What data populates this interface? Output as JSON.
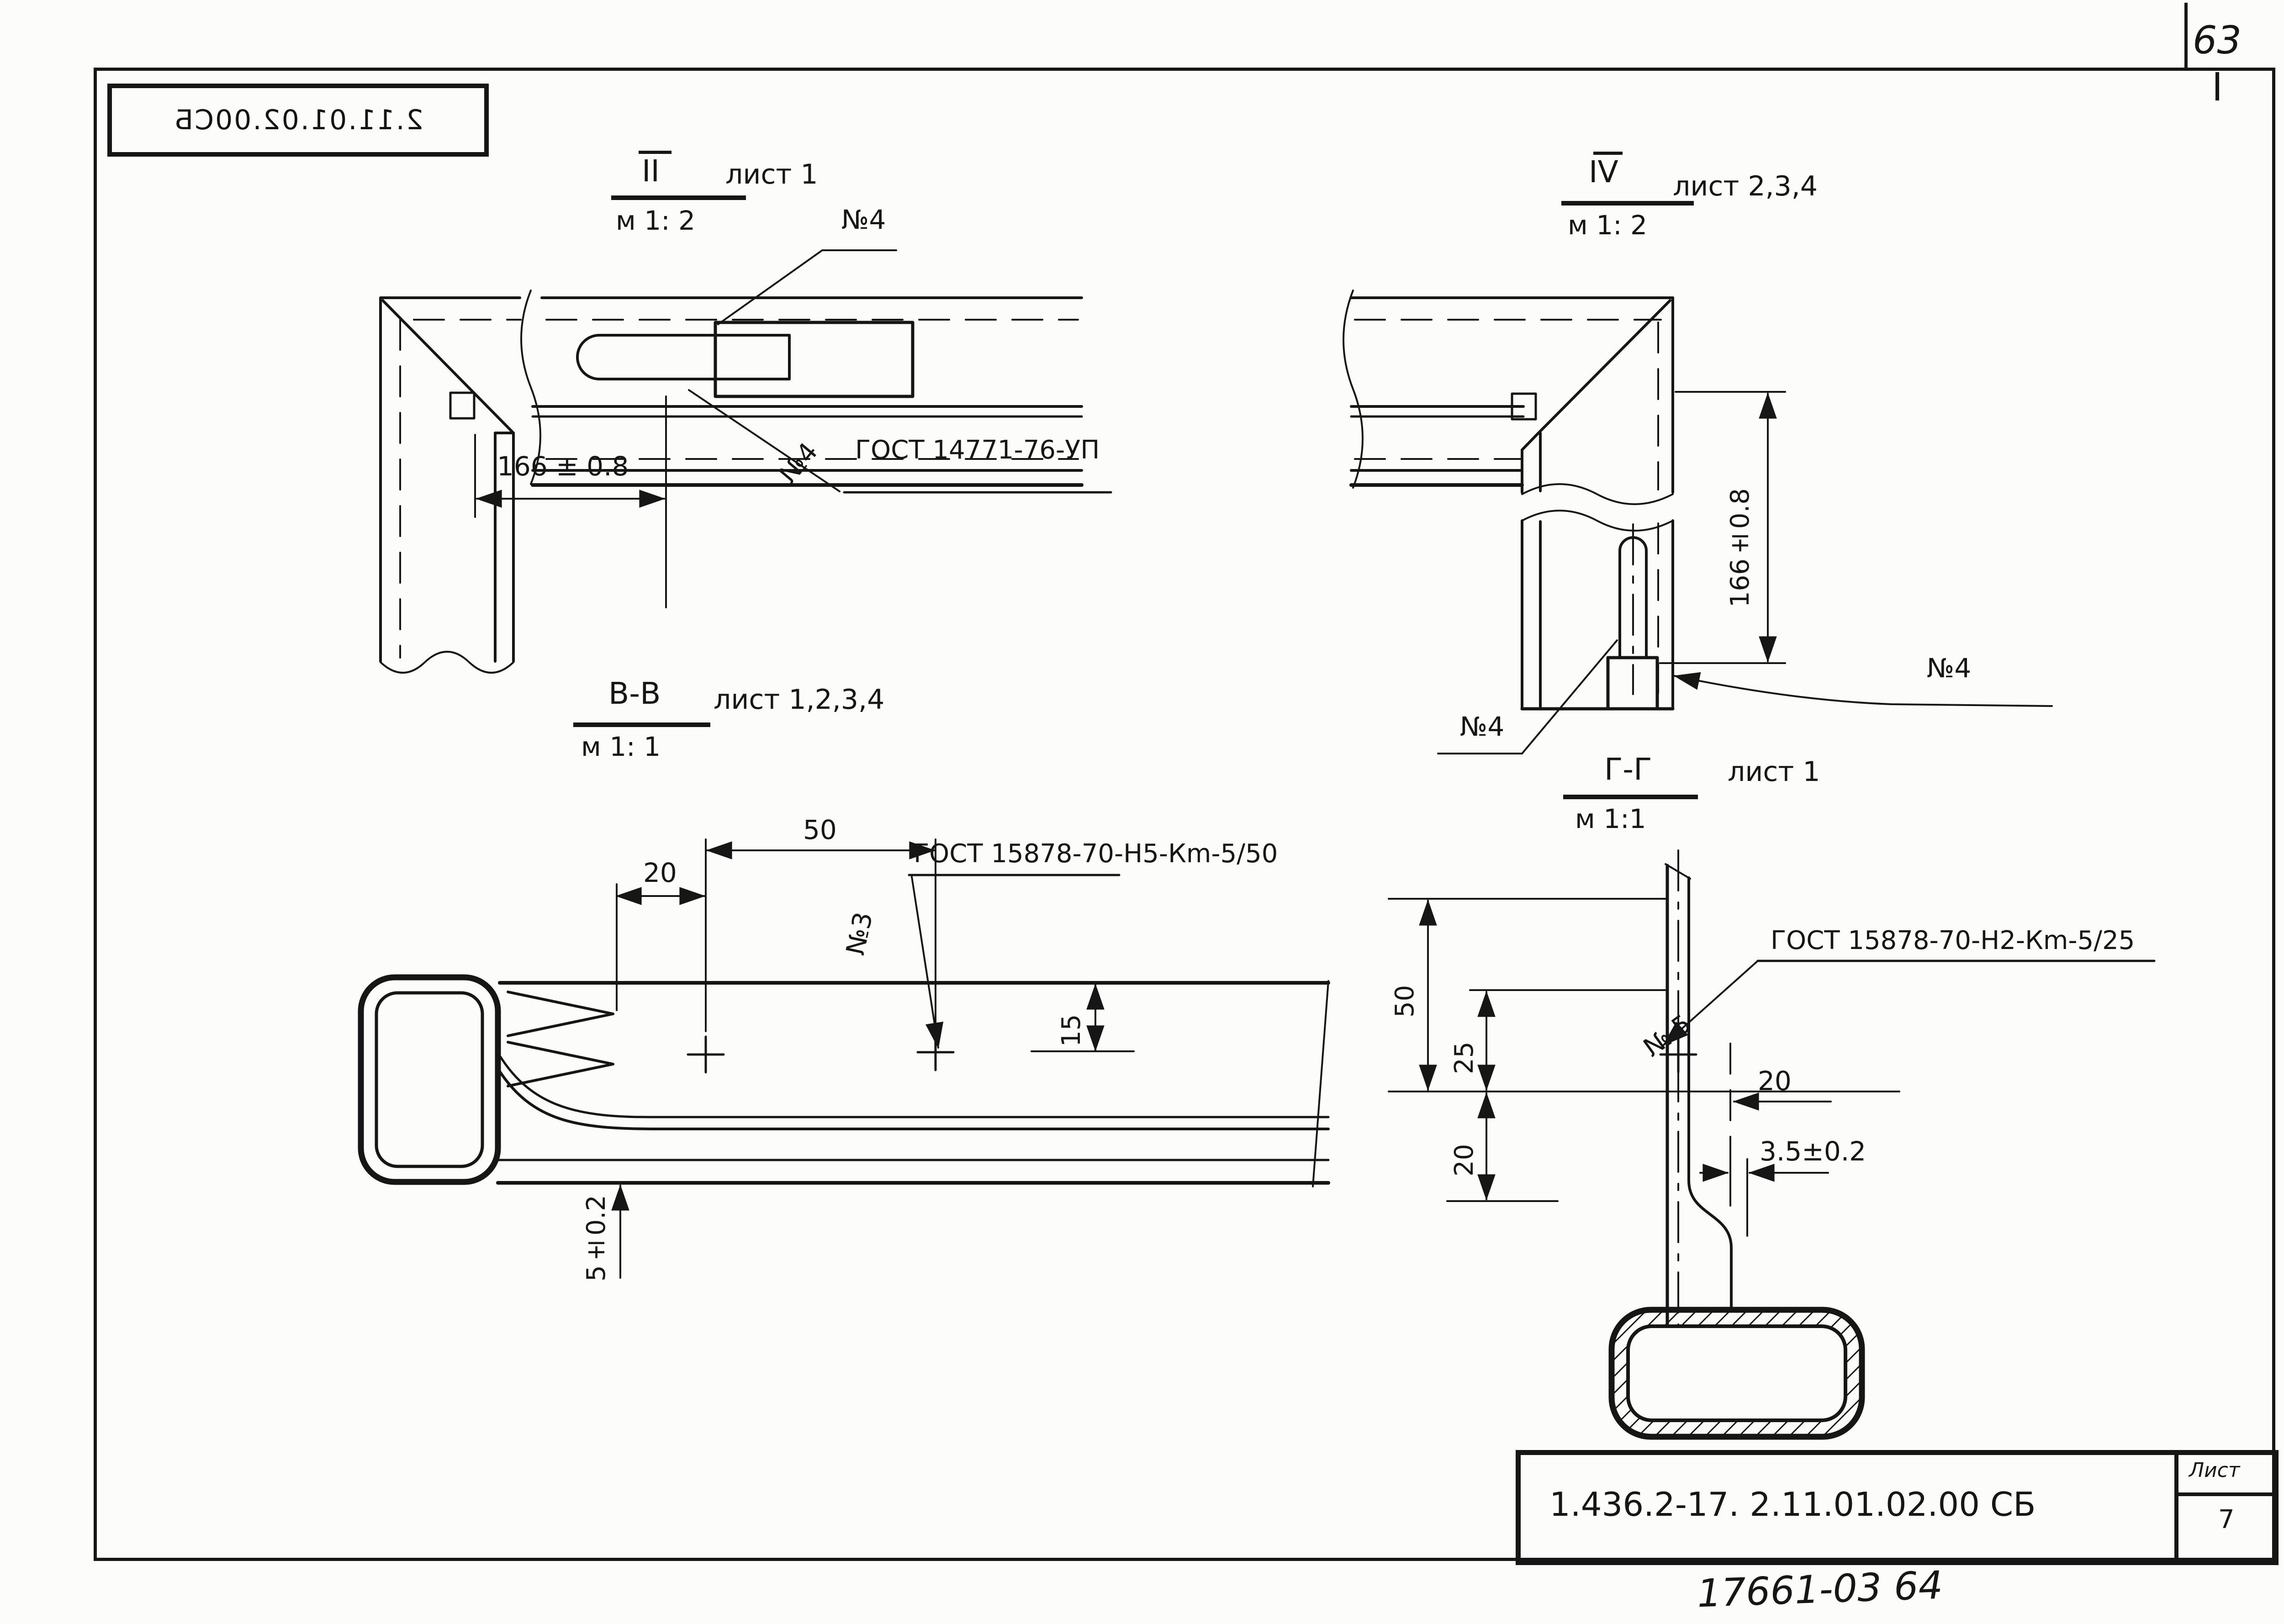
{
  "page": {
    "page_number": "63",
    "back_stamp": "2.11.01.02.00СБ"
  },
  "views": {
    "view_ii": {
      "label": "II",
      "scale": "м 1: 2",
      "sheets": "лист 1",
      "callout_plate": "№4",
      "weld_callout_no": "№4",
      "weld_spec": "ГОСТ 14771-76-УП",
      "dim_width": "166 ± 0.8"
    },
    "view_iv": {
      "label": "IV",
      "scale": "м 1: 2",
      "sheets": "лист 2,3,4",
      "dim_height": "166±0.8",
      "callout_left": "№4",
      "callout_right": "№4"
    },
    "section_vv": {
      "label": "В-В",
      "scale": "м 1: 1",
      "sheets": "лист 1,2,3,4",
      "dim_50": "50",
      "dim_20": "20",
      "dim_15": "15",
      "dim_5": "5±0.2",
      "weld_callout_no": "№3",
      "weld_spec": "ГОСТ 15878-70-Н5-Кm-5/50"
    },
    "section_gg": {
      "label": "Г-Г",
      "scale": "м 1:1",
      "sheets": "лист 1",
      "dim_50": "50",
      "dim_25": "25",
      "dim_20_vert": "20",
      "dim_20_horiz": "20",
      "dim_3_5": "3.5±0.2",
      "weld_callout_no": "№ 5",
      "weld_spec": "ГОСТ 15878-70-Н2-Кm-5/25"
    }
  },
  "title_block": {
    "document_number": "1.436.2-17.  2.11.01.02.00 СБ",
    "sheet_label": "Лист",
    "sheet_number": "7",
    "handwritten_note": "17661-03  64"
  }
}
